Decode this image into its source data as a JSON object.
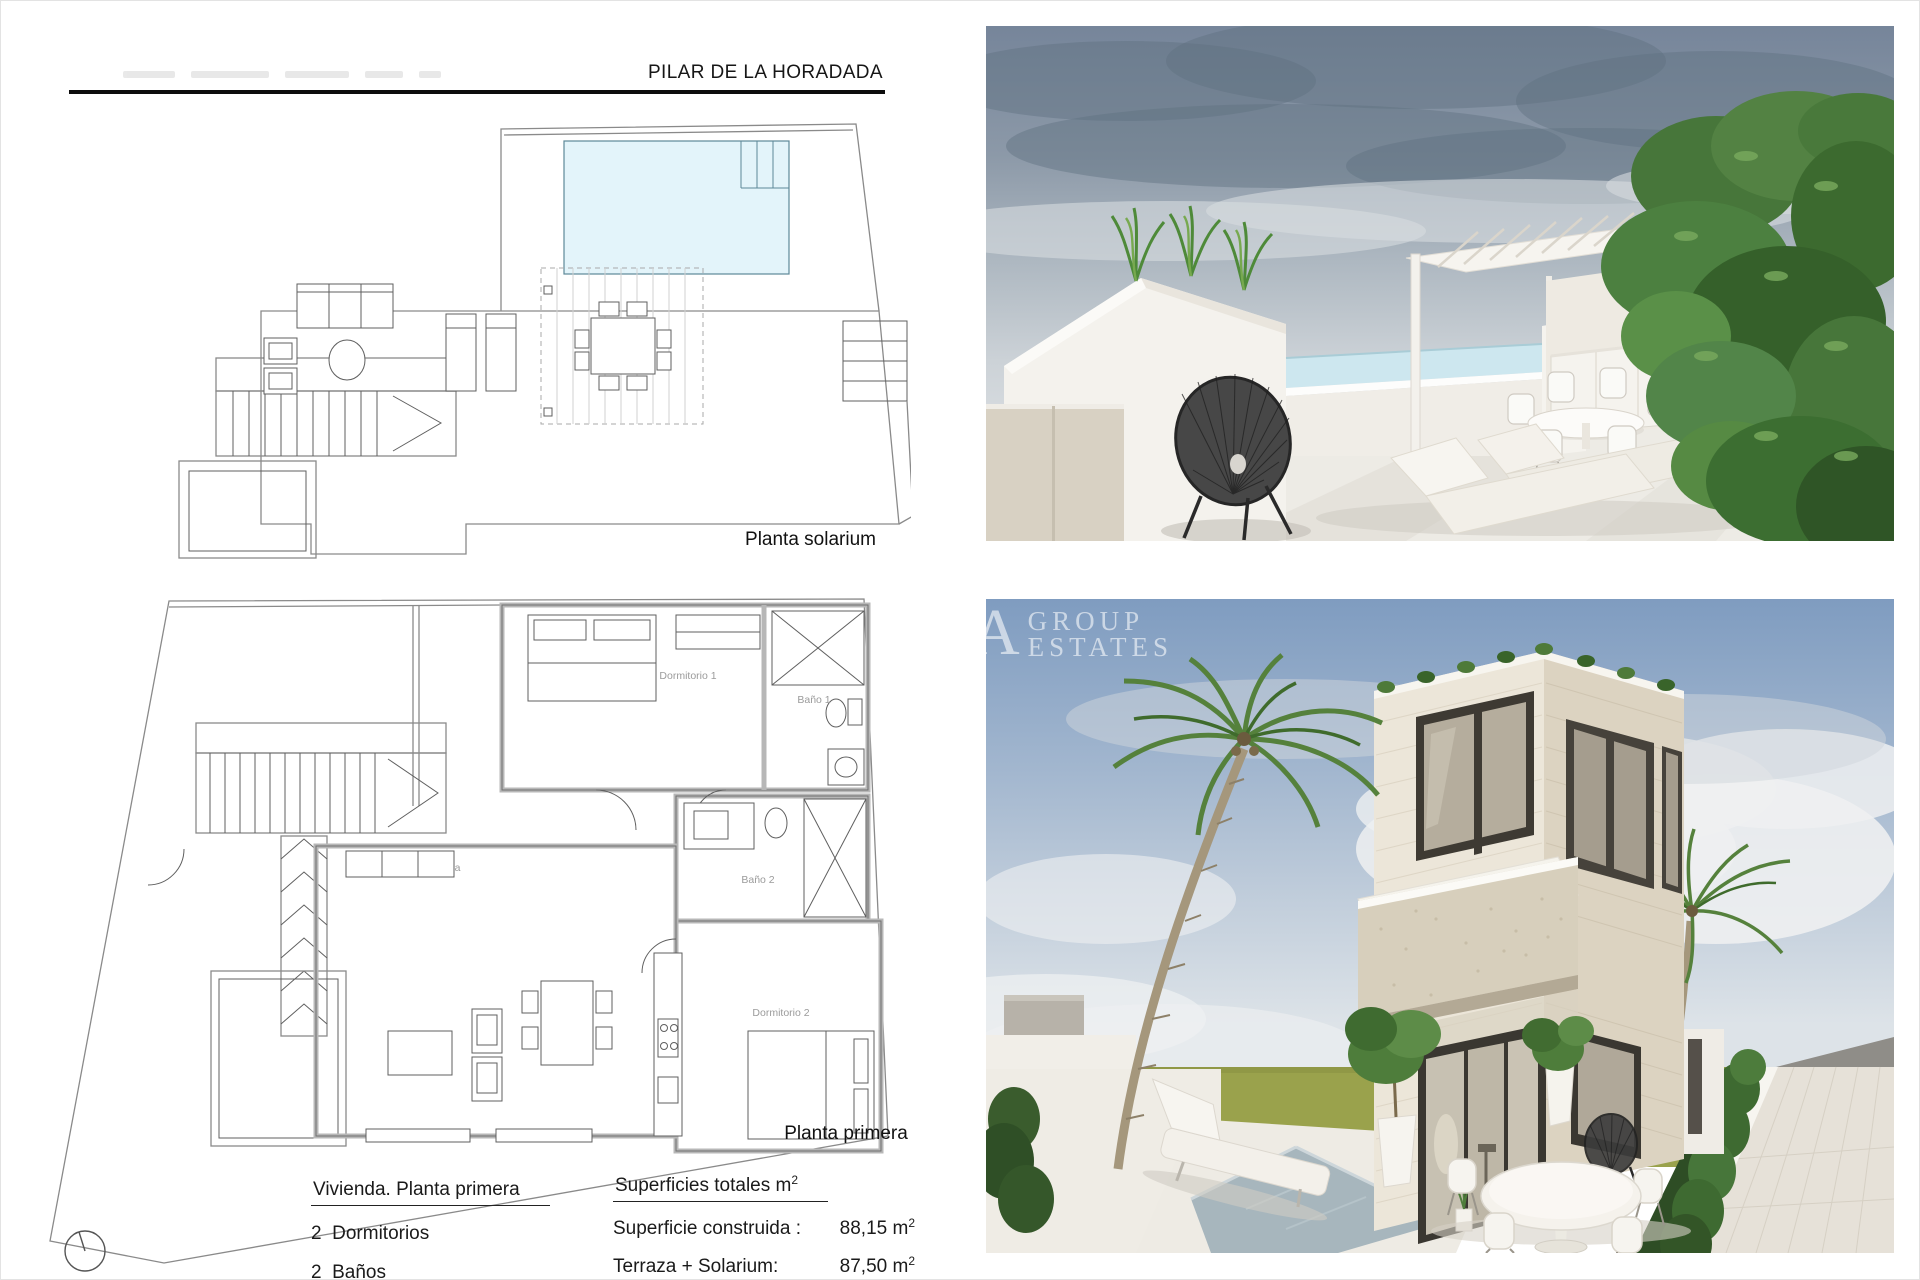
{
  "header": {
    "title": "PILAR DE LA HORADADA"
  },
  "solarium_plan": {
    "caption": "Planta solarium"
  },
  "first_floor_plan": {
    "caption": "Planta primera",
    "room_labels": {
      "dormitorio1": "Dormitorio 1",
      "bano1": "Baño 1",
      "bano2": "Baño 2",
      "dormitorio2": "Dormitorio 2",
      "salon": "Salón-comedor-cocina"
    }
  },
  "summary": {
    "dwelling_heading": "Vivienda. Planta primera",
    "bedrooms": "2  Dormitorios",
    "bathrooms": "2  Baños",
    "areas_heading": "Superficies totales m",
    "areas_heading_sup": "2",
    "rows": [
      {
        "label": "Superficie construida : ",
        "value": "88,15 m",
        "sup": "2"
      },
      {
        "label": "Terraza + Solarium: ",
        "value": "87,50 m",
        "sup": "2"
      }
    ]
  },
  "watermark": {
    "initial": "A",
    "line1": "GROUP",
    "line2": "ESTATES"
  },
  "colors": {
    "pool_plan_fill": "#e3f4fa",
    "plan_line": "#8a8a8a",
    "terrace_sky": "#76859a",
    "villa_sky": "#7f9cc0",
    "grass": "#99a14b",
    "render_white": "#f2efe9",
    "render_pool": "#a7b6bd",
    "foliage": "#47763a"
  }
}
